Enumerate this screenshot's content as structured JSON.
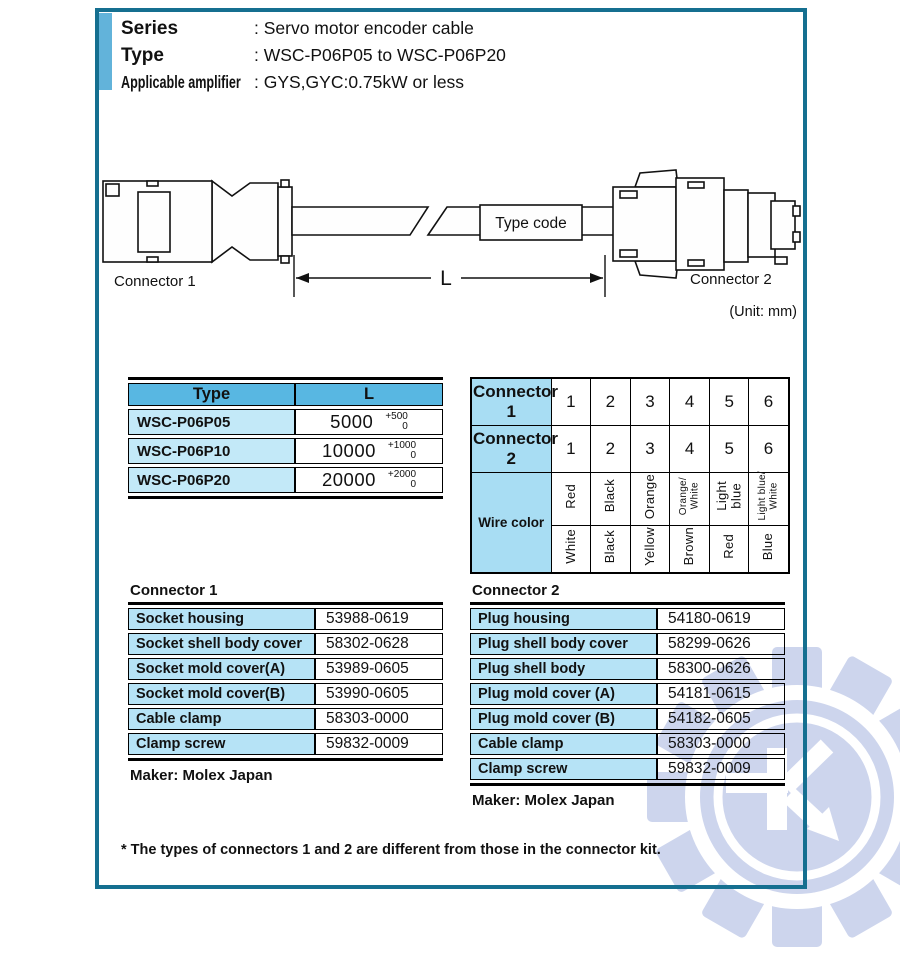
{
  "header": {
    "rows": [
      {
        "label": "Series",
        "value": ": Servo motor encoder cable"
      },
      {
        "label": "Type",
        "value": ": WSC-P06P05 to WSC-P06P20"
      },
      {
        "label": "Applicable amplifier",
        "value": ": GYS,GYC:0.75kW or less"
      }
    ]
  },
  "diagram": {
    "connector1_label": "Connector 1",
    "connector2_label": "Connector 2",
    "type_code_label": "Type code",
    "length_label": "L",
    "unit_note": "(Unit: mm)"
  },
  "length_table": {
    "headers": [
      "Type",
      "L"
    ],
    "rows": [
      {
        "type": "WSC-P06P05",
        "length": "5000",
        "tol_plus": "+500",
        "tol_zero": "0"
      },
      {
        "type": "WSC-P06P10",
        "length": "10000",
        "tol_plus": "+1000",
        "tol_zero": "0"
      },
      {
        "type": "WSC-P06P20",
        "length": "20000",
        "tol_plus": "+2000",
        "tol_zero": "0"
      }
    ]
  },
  "pin_table": {
    "rows": [
      {
        "label": "Connector 1",
        "pins": [
          "1",
          "2",
          "3",
          "4",
          "5",
          "6"
        ]
      },
      {
        "label": "Connector 2",
        "pins": [
          "1",
          "2",
          "3",
          "4",
          "5",
          "6"
        ]
      }
    ],
    "wire_label": "Wire color",
    "wire_top": [
      "Red",
      "Black",
      "Orange",
      "Orange/\nWhite",
      "Light\nblue",
      "Light blue/\nWhite"
    ],
    "wire_bottom": [
      "White",
      "Black",
      "Yellow",
      "Brown",
      "Red",
      "Blue"
    ]
  },
  "connector1_parts": {
    "title": "Connector 1",
    "rows": [
      [
        "Socket housing",
        "53988-0619"
      ],
      [
        "Socket shell body cover",
        "58302-0628"
      ],
      [
        "Socket mold cover(A)",
        "53989-0605"
      ],
      [
        "Socket mold cover(B)",
        "53990-0605"
      ],
      [
        "Cable clamp",
        "58303-0000"
      ],
      [
        "Clamp screw",
        "59832-0009"
      ]
    ],
    "maker": "Maker: Molex Japan"
  },
  "connector2_parts": {
    "title": "Connector 2",
    "rows": [
      [
        "Plug housing",
        "54180-0619"
      ],
      [
        "Plug shell body cover",
        "58299-0626"
      ],
      [
        "Plug shell body",
        "58300-0626"
      ],
      [
        "Plug mold cover (A)",
        "54181-0615"
      ],
      [
        "Plug mold cover (B)",
        "54182-0605"
      ],
      [
        "Cable clamp",
        "58303-0000"
      ],
      [
        "Clamp screw",
        "59832-0009"
      ]
    ],
    "maker": "Maker: Molex Japan"
  },
  "footnote": "* The types of connectors 1 and 2 are different from those in the connector kit.",
  "colors": {
    "frame_border": "#156f90",
    "accent_bar": "#62b3da",
    "table_header_blue": "#58b7e2",
    "length_cell_blue": "#c3e9f8",
    "pin_label_blue": "#a8ddf3",
    "parts_label_blue": "#b6e3f6",
    "watermark_blue": "#cdd5ed"
  }
}
